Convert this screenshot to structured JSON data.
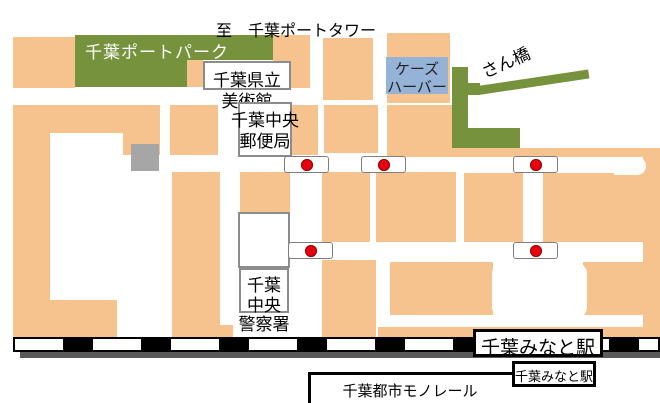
{
  "top_label": "至　千葉ポートタワー",
  "landmarks": {
    "port_park": {
      "label": "千葉ポートパーク"
    },
    "art_museum": {
      "line1": "千葉県立",
      "line2": "美術館"
    },
    "post_office": {
      "line1": "千葉中央",
      "line2": "郵便局"
    },
    "ks_harbor": {
      "line1": "ケーズ",
      "line2": "ハーバー"
    },
    "pier": {
      "label": "さん橋"
    },
    "police": {
      "line1": "千葉",
      "line2": "中央",
      "line3": "警察署"
    }
  },
  "stations": {
    "jr_station": {
      "label": "千葉みなと駅"
    },
    "monorail_station": {
      "label": "千葉みなと駅"
    },
    "monorail_line": {
      "label": "千葉都市モノレール"
    }
  },
  "traffic_lights": {
    "count": 5,
    "dot_order": [
      "blue",
      "yellow",
      "red"
    ]
  },
  "colors": {
    "block": "#F6C28D",
    "park": "#76923C",
    "harbor": "#95B3D7",
    "graybldg": "#A6A6A6",
    "dotblue": "#4F81BD",
    "dotyellow": "#FFFF00",
    "dotred": "#E60012",
    "railshadow": "#5A5A5A"
  }
}
